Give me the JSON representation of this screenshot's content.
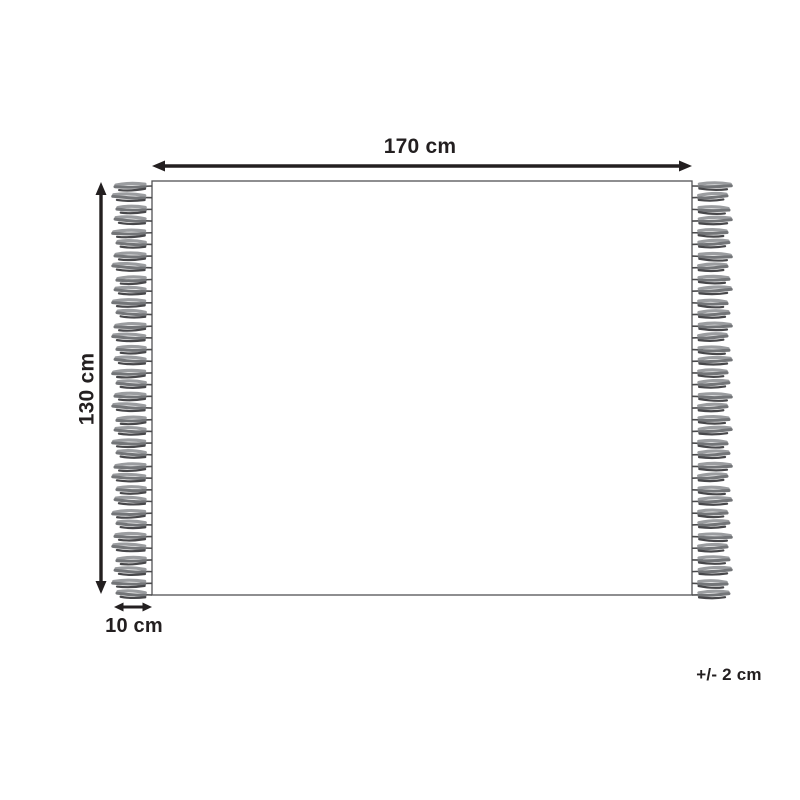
{
  "diagram": {
    "kind": "product-dimension-diagram",
    "product_shape": "rectangular rug with fringe on left and right edges",
    "labels": {
      "width": "170 cm",
      "height": "130 cm",
      "fringe": "10 cm",
      "tolerance": "+/- 2 cm"
    },
    "measurements": {
      "width_cm": 170,
      "height_cm": 130,
      "fringe_cm": 10,
      "tolerance_cm": 2
    },
    "fringe": {
      "tassels_per_side": 36,
      "sides": [
        "left",
        "right"
      ]
    },
    "colors": {
      "background": "#ffffff",
      "outline": "#515254",
      "dimension_ink": "#231f20",
      "tassel_light": "#9b9da0",
      "tassel_mid": "#737578",
      "tassel_dark": "#47474a",
      "thread": "#4a4a4c"
    }
  }
}
